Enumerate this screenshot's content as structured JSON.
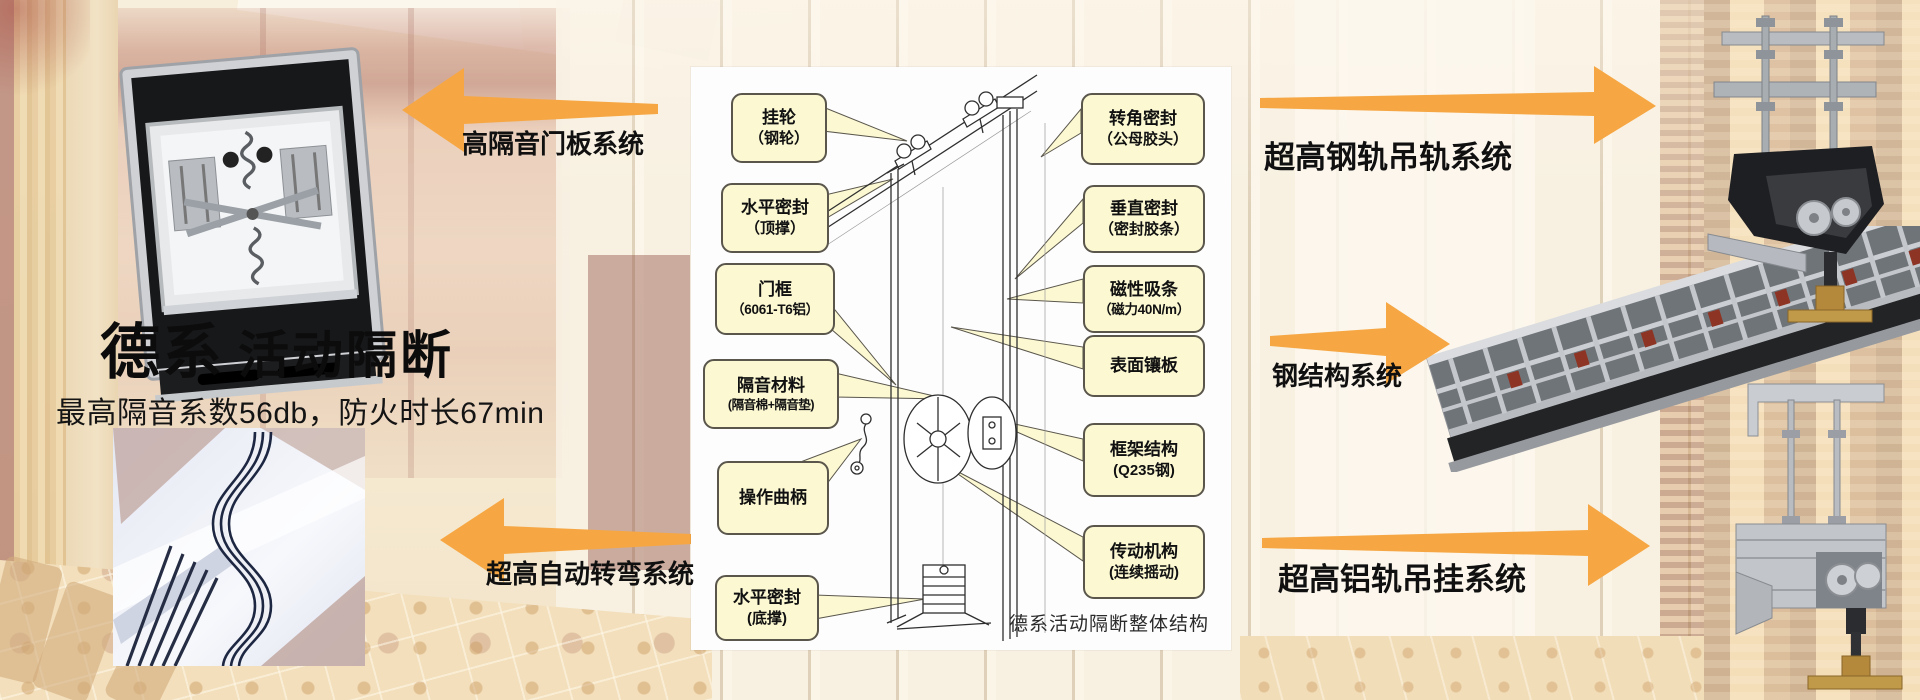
{
  "page": {
    "title_bold": "德系",
    "title_rest": "活动隔断",
    "subtitle": "最高隔音系数56db，防火时长67min"
  },
  "systems": {
    "door_panel": "高隔音门板系统",
    "auto_turn": "超高自动转弯系统",
    "steel_rail": "超高钢轨吊轨系统",
    "steel_structure": "钢结构系统",
    "alum_rail": "超高铝轨吊挂系统"
  },
  "diagram": {
    "caption": "德系活动隔断整体结构",
    "callouts_left": [
      {
        "line1": "挂轮",
        "line2": "（钢轮）"
      },
      {
        "line1": "水平密封",
        "line2": "（顶撑）"
      },
      {
        "line1": "门框",
        "line2": "（6061-T6铝）"
      },
      {
        "line1": "隔音材料",
        "line2": "(隔音棉+隔音垫)"
      },
      {
        "line1": "操作曲柄",
        "line2": ""
      },
      {
        "line1": "水平密封",
        "line2": "(底撑)"
      }
    ],
    "callouts_right": [
      {
        "line1": "转角密封",
        "line2": "（公母胶头）"
      },
      {
        "line1": "垂直密封",
        "line2": "（密封胶条）"
      },
      {
        "line1": "磁性吸条",
        "line2": "（磁力40N/m）"
      },
      {
        "line1": "表面镶板",
        "line2": ""
      },
      {
        "line1": "框架结构",
        "line2": "(Q235钢)"
      },
      {
        "line1": "传动机构",
        "line2": "(连续摇动)"
      }
    ]
  },
  "colors": {
    "accent_orange": "#F6A743",
    "callout_fill": "#FBF8D2",
    "callout_border": "#5A564C"
  }
}
